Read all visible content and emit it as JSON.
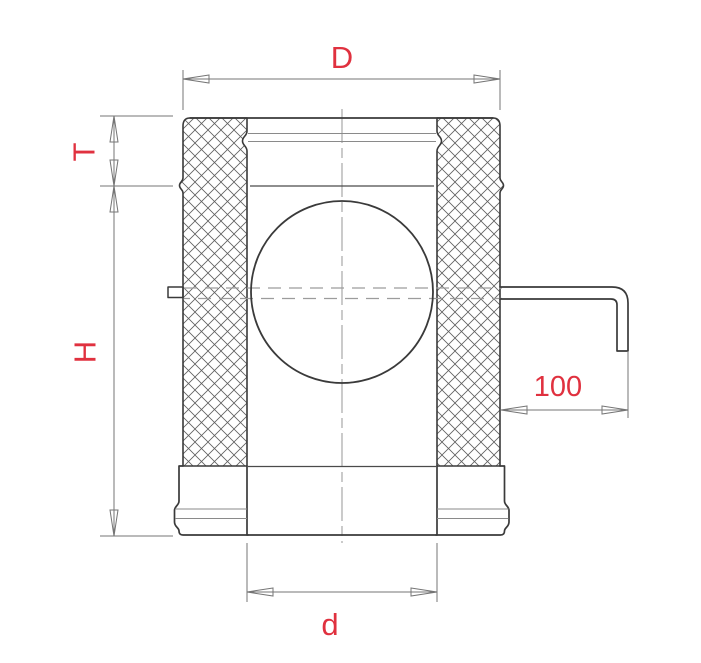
{
  "labels": {
    "outer_diameter": "D",
    "socket_depth": "T",
    "height": "H",
    "handle_length": "100",
    "inner_diameter": "d"
  },
  "colors": {
    "label_red": "#e0313f",
    "outline_dark": "#3a3a3a",
    "dim_gray": "#757575",
    "hatch_gray": "#5f5f5f",
    "hidden_gray": "#9c9c9c",
    "background": "#ffffff"
  }
}
